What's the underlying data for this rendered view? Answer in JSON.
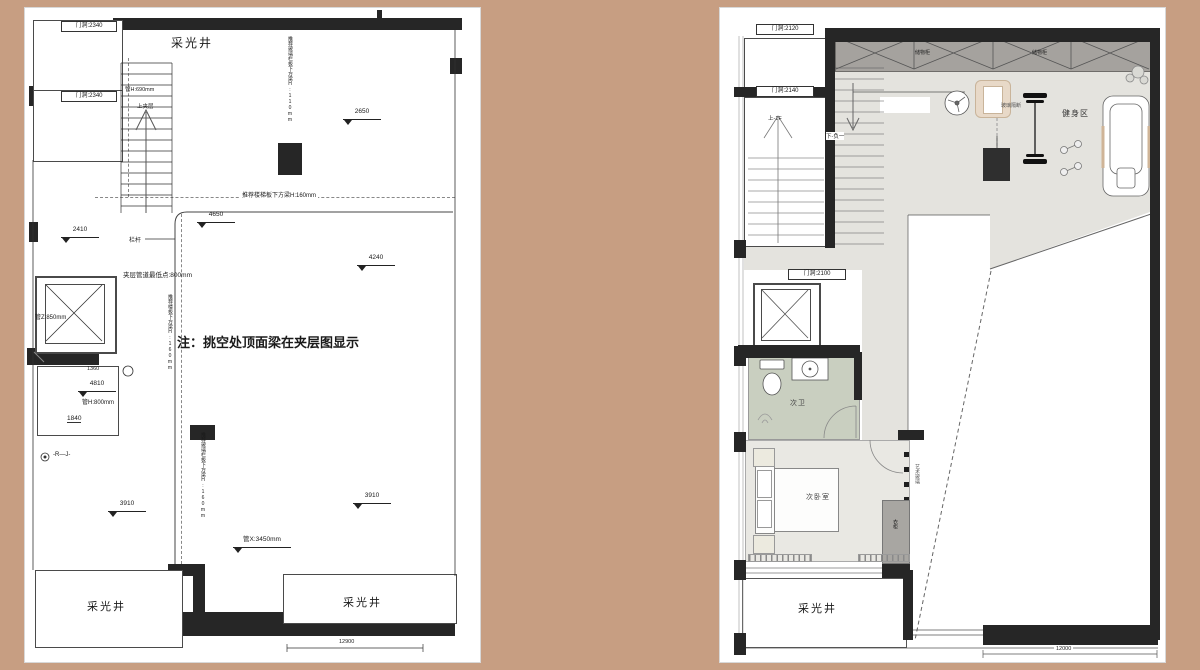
{
  "palette": {
    "background": "#c79e82",
    "wall": "#262626",
    "floor_grey": "#e4e3de",
    "bath_green": "#c9cfc0",
    "storage_grey": "#a5a29e"
  },
  "left_plan": {
    "door_labels": [
      "门洞:2340",
      "门洞:2340"
    ],
    "light_wells": [
      "采光井",
      "采光井",
      "采光井"
    ],
    "stairs": {
      "up": "上夹层",
      "pipe": "管H:690mm"
    },
    "notes": {
      "main": "注：挑空处顶面梁在夹层图显示",
      "beam_top": "推荐楼梯板下方梁H:160mm",
      "beam_v1": "推荐玻璃栏板下方梁H:110mm",
      "beam_v2": "推荐楼板下方梁H:160mm",
      "beam_v3": "推荐玻璃栏板下方梁H:160mm",
      "railing": "栏杆",
      "duct": "夹层管道最低点:800mm",
      "pipe_z": "管Z:850mm",
      "pipe_h": "管H:800mm",
      "pipe_x": "管X:3450mm",
      "rj": "-R—J-"
    },
    "levels": [
      "2650",
      "2410",
      "4650",
      "4240",
      "4810",
      "3910",
      "3910"
    ],
    "dims": {
      "d1840": "1840",
      "d1360": "1360",
      "bottom": "12900"
    }
  },
  "right_plan": {
    "door_labels": [
      "门洞:2120",
      "门洞:2140",
      "门洞:2100"
    ],
    "storage_labels": [
      "储物柜",
      "储物柜"
    ],
    "stairs": {
      "up": "上-1F",
      "down": "下-负一"
    },
    "rooms": {
      "gym": "健身区",
      "bath": "次卫",
      "bedroom": "次卧室",
      "light_well": "采光井"
    },
    "furniture": {
      "wardrobe": "衣柜",
      "art": "艺术玻璃",
      "partition": "玻璃隔断"
    },
    "dims": {
      "bottom": "12000"
    }
  }
}
